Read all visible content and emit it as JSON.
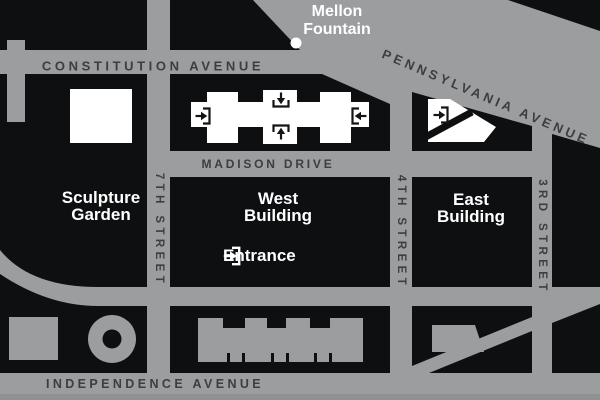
{
  "colors": {
    "street_gray": "#9b9d9f",
    "block_black": "#0e0f10",
    "street_label_dark": "#3e3d3f",
    "building_label_white": "#ffffff",
    "bottom_stripe_gray": "#8f9193"
  },
  "streets": {
    "constitution_avenue": "CONSTITUTION AVENUE",
    "pennsylvania_avenue": "PENNSYLVANIA AVENUE",
    "madison_drive": "MADISON DRIVE",
    "independence_avenue": "INDEPENDENCE AVENUE",
    "seventh_street": "7TH STREET",
    "fourth_street": "4TH STREET",
    "third_street": "3RD STREET"
  },
  "landmarks": {
    "mellon_fountain": {
      "line1": "Mellon",
      "line2": "Fountain"
    },
    "sculpture_garden": {
      "line1": "Sculpture",
      "line2": "Garden"
    },
    "west_building": {
      "line1": "West",
      "line2": "Building"
    },
    "east_building": {
      "line1": "East",
      "line2": "Building"
    },
    "entrance_label": "Entrance"
  },
  "icons": {
    "entrance_marker": "arrow-into-bracket",
    "west_building_entrance_sides": [
      "west",
      "north",
      "south",
      "east"
    ],
    "east_building_entrance_side": "west",
    "mellon_fountain_dot": "white-circle"
  }
}
